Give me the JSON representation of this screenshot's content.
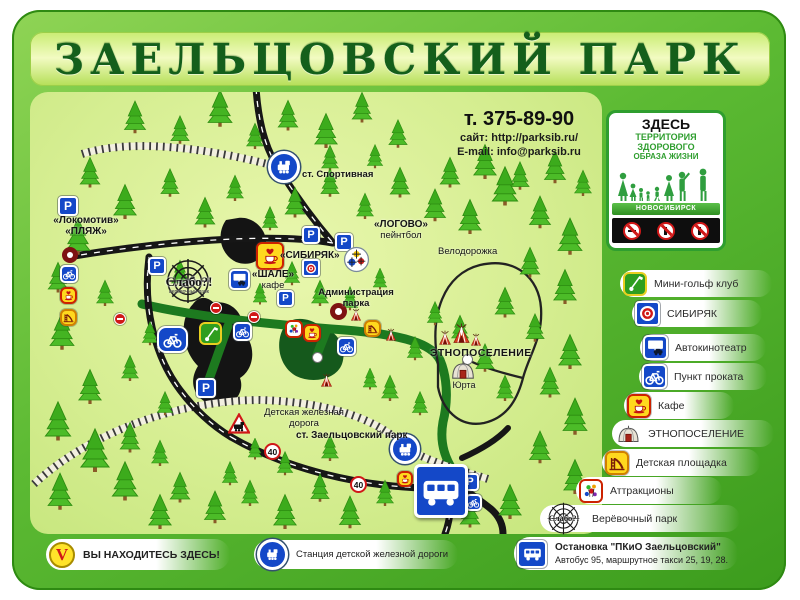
{
  "title": "ЗАЕЛЬЦОВСКИЙ ПАРК",
  "contact": {
    "phone": "т. 375-89-90",
    "site": "сайт: http://parksib.ru/",
    "email": "E-mail: info@parksib.ru"
  },
  "health_panel": {
    "line1": "ЗДЕСЬ",
    "line2": "ТЕРРИТОРИЯ",
    "line3": "ЗДОРОВОГО",
    "line4": "ОБРАЗА ЖИЗНИ",
    "city": "НОВОСИБИРСК"
  },
  "legend": {
    "items": [
      {
        "icon": "minigolf-icon",
        "label": "Мини-гольф клуб"
      },
      {
        "icon": "sibiryak-target-icon",
        "label": "СИБИРЯК"
      },
      {
        "icon": "drive-in-cinema-icon",
        "label": "Автокинотеатр"
      },
      {
        "icon": "bike-rental-icon",
        "label": "Пункт проката"
      },
      {
        "icon": "cafe-icon",
        "label": "Кафе"
      },
      {
        "icon": "yurt-icon",
        "label": "ЭТНОПОСЕЛЕНИЕ"
      },
      {
        "icon": "playground-icon",
        "label": "Детская площадка"
      },
      {
        "icon": "attractions-icon",
        "label": "Аттракционы"
      },
      {
        "icon": "rope-park-logo",
        "label": "Верёвочный парк"
      }
    ]
  },
  "map": {
    "parking_letter": "P",
    "speed_limit": "40",
    "st_sportivnaya": "ст. Спортивная",
    "lokomotiv": "«Локомотив»",
    "plyazh": "«ПЛЯЖ»",
    "logovo": "«ЛОГОВО»",
    "paintball": "пейнтбол",
    "sibiryak": "«СИБИРЯК»",
    "chalet": "«ШАЛЕ»",
    "chalet_cafe": "кафе",
    "administration_line1": "Администрация",
    "administration_line2": "парка",
    "velodorozhka": "Велодорожка",
    "ethno_village": "ЭТНОПОСЕЛЕНИЕ",
    "yurt": "Юрта",
    "children_railway_line1": "Детская железная",
    "children_railway_line2": "дорога",
    "st_zaeltsovsky": "ст. Заельцовский парк",
    "slabo": "Слабо?!",
    "slabo_sub": "верёвочный парк"
  },
  "footer": {
    "you_are_here": "ВЫ НАХОДИТЕСЬ ЗДЕСЬ!",
    "children_station": "Станция детской железной дороги",
    "bus_stop_title": "Остановка \"ПКиО Заельцовский\"",
    "bus_stop_sub": "Автобус 95, маршрутное такси 25, 19, 28."
  },
  "colors": {
    "frame_green": "#4aa82a",
    "map_background": "#d6ee92",
    "accent_green": "#2f9e2f",
    "sign_blue": "#1448c8",
    "sign_yellow": "#ffd81e",
    "sign_red": "#d01818",
    "title_green": "#145f1b"
  }
}
